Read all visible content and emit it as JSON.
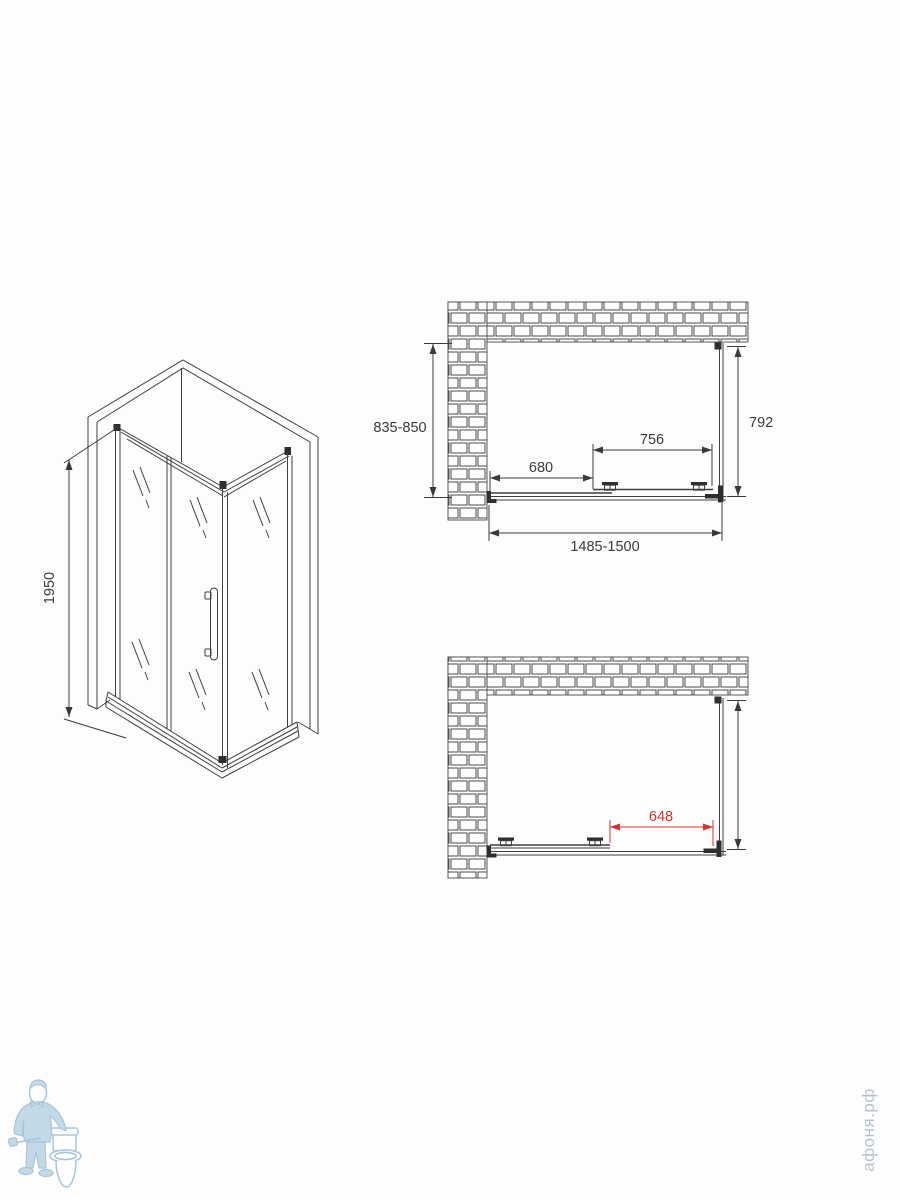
{
  "page": {
    "background": "#fdfdfd",
    "line_color": "#3f3f3f",
    "accent_red": "#cc3333",
    "watermark_color": "#b7c2cf"
  },
  "drawings": {
    "isometric": {
      "title": "shower-enclosure-isometric-view",
      "dims": {
        "height": {
          "label": "1950",
          "orientation": "vertical"
        }
      }
    },
    "plan_closed": {
      "title": "top-view-door-closed",
      "dims": {
        "depth": {
          "label": "835-850"
        },
        "side_panel": {
          "label": "792"
        },
        "door": {
          "label": "756"
        },
        "fixed_panel": {
          "label": "680"
        },
        "width_range": {
          "label": "1485-1500"
        }
      }
    },
    "plan_open": {
      "title": "top-view-door-open",
      "dims": {
        "opening": {
          "label": "648",
          "color": "#cc3333"
        }
      }
    }
  },
  "watermarks": {
    "logo_icon": "plumber-with-toilet-logo",
    "site": "афоня.рф"
  }
}
